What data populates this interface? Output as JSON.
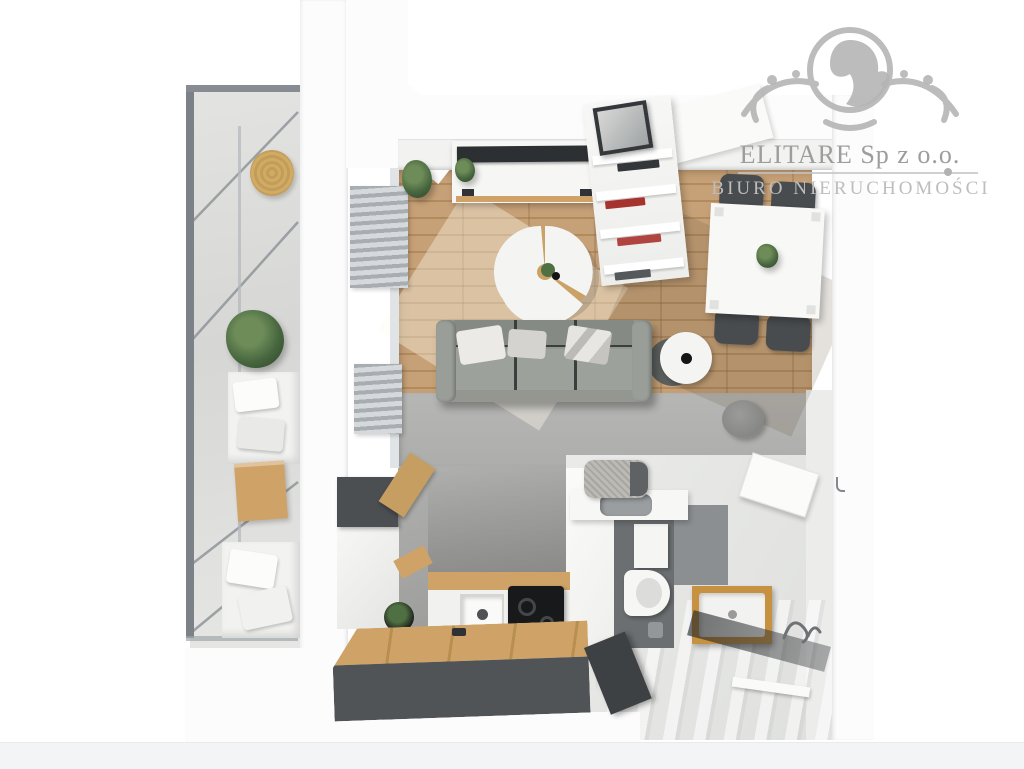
{
  "watermark": {
    "company": "ELITARE Sp z o.o.",
    "tagline": "BIURO NIERUCHOMOŚCI"
  },
  "palette": {
    "wall_white": "#fcfcfd",
    "wood_floor": "#c6a077",
    "wood_line": "#b18b5e",
    "wood_counter": "#cfa368",
    "wood_frame": "#c69140",
    "concrete": "#b2b2b0",
    "balcony_floor": "#dcdcda",
    "sofa": "#93978f",
    "furn_dark": "#4b4f51",
    "chair_dark": "#484c4e",
    "cooktop": "#17191a",
    "plant_green": "#47663f",
    "straw": "#d0ab66",
    "glass_gray": "#7b8187",
    "watermark_gray": "#b5b5b5",
    "text_gray": "#9d9d9d",
    "tagline_gray": "#bdbdbd"
  }
}
